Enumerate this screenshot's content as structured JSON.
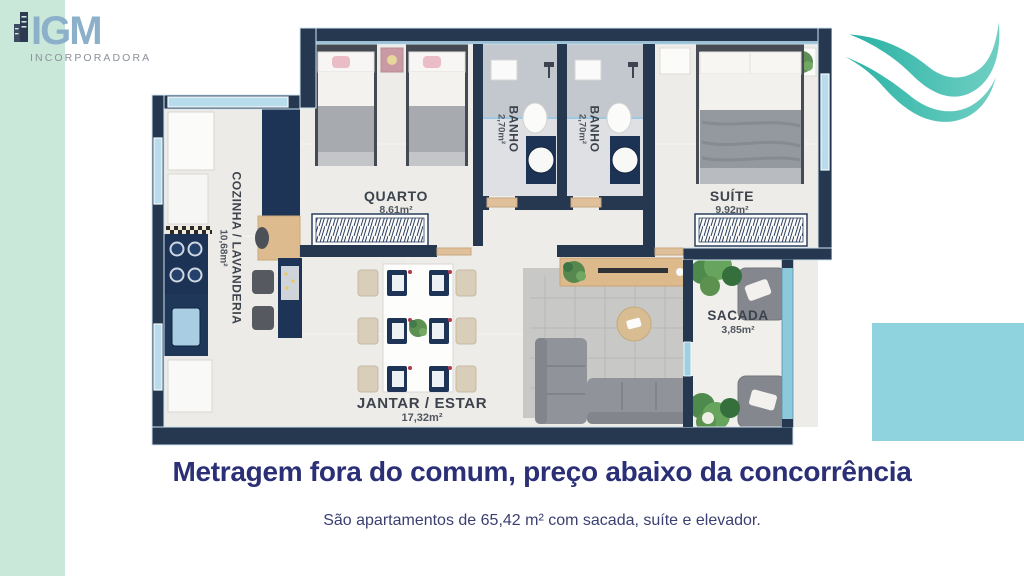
{
  "branding": {
    "logo_text": "IGM",
    "logo_subtext": "INCORPORADORA"
  },
  "decor": {
    "left_strip_color": "#c9e8da",
    "right_block_color": "#8ed3de",
    "wave_color_start": "#29b2a4",
    "wave_color_end": "#71cfc4"
  },
  "floorplan": {
    "wall_color": "#253850",
    "window_color": "#b8dcec",
    "rooms": [
      {
        "name": "QUARTO",
        "area": "8,61m²"
      },
      {
        "name": "BANHO",
        "area": "2,70m²"
      },
      {
        "name": "BANHO",
        "area": "2,70m²"
      },
      {
        "name": "SUÍTE",
        "area": "9,92m²"
      },
      {
        "name": "COZINHA / LAVANDERIA",
        "area": "10,68m²"
      },
      {
        "name": "JANTAR / ESTAR",
        "area": "17,32m²"
      },
      {
        "name": "SACADA",
        "area": "3,85m²"
      }
    ]
  },
  "headline": "Metragem fora do comum, preço abaixo da concorrência",
  "subheadline": "São apartamentos de 65,42 m² com sacada, suíte e elevador."
}
